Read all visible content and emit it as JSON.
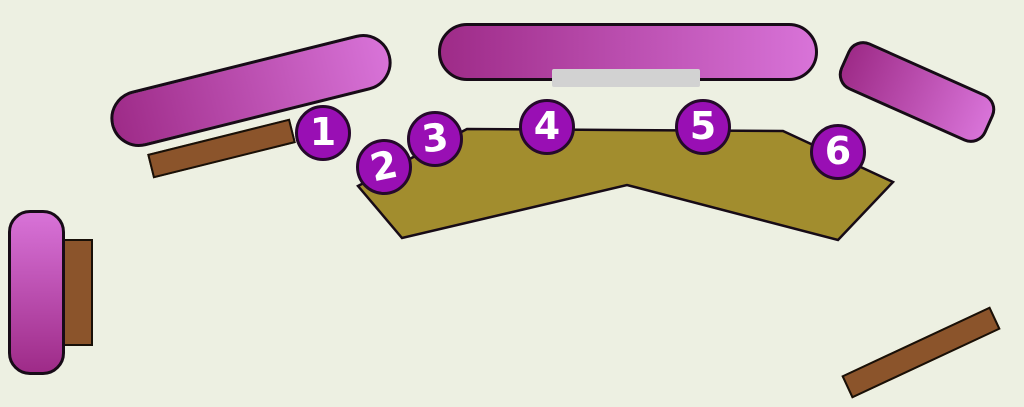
{
  "markers": [
    {
      "id": 1,
      "label": "1"
    },
    {
      "id": 2,
      "label": "2"
    },
    {
      "id": 3,
      "label": "3"
    },
    {
      "id": 4,
      "label": "4"
    },
    {
      "id": 5,
      "label": "5"
    },
    {
      "id": 6,
      "label": "6"
    }
  ],
  "colors": {
    "bg": "#edf0e2",
    "marker-fill": "#990fb4",
    "marker-stroke": "#25092b",
    "marker-text": "#ffffff",
    "magenta-dark": "#9e2b88",
    "magenta-light": "#d873d8",
    "olive": "#a28d2e",
    "brown": "#8b542b",
    "outline": "#170b17",
    "strip": "#d2d2d2"
  }
}
